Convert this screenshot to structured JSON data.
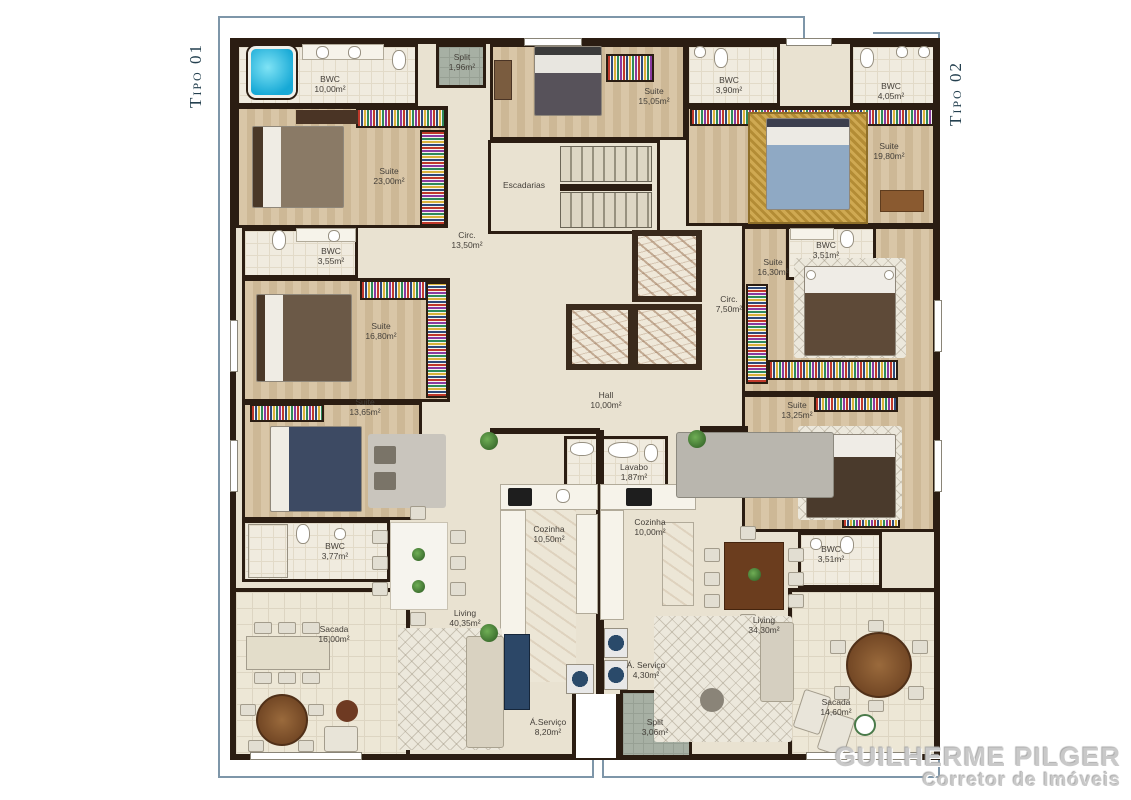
{
  "units": {
    "tipo01": {
      "label": "Tipo 01"
    },
    "tipo02": {
      "label": "Tipo 02"
    }
  },
  "rooms": {
    "bwc10": {
      "name": "BWC",
      "area": "10,00m²"
    },
    "split196": {
      "name": "Split",
      "area": "1,96m²"
    },
    "suite1505": {
      "name": "Suite",
      "area": "15,05m²"
    },
    "bwc390": {
      "name": "BWC",
      "area": "3,90m²"
    },
    "bwc405": {
      "name": "BWC",
      "area": "4,05m²"
    },
    "suite2300": {
      "name": "Suite",
      "area": "23,00m²"
    },
    "suite1980": {
      "name": "Suite",
      "area": "19,80m²"
    },
    "escadarias": {
      "name": "Escadarias",
      "area": ""
    },
    "circ1350": {
      "name": "Circ.",
      "area": "13,50m²"
    },
    "bwc355": {
      "name": "BWC",
      "area": "3,55m²"
    },
    "bwc351a": {
      "name": "BWC",
      "area": "3,51m²"
    },
    "suite1630": {
      "name": "Suite",
      "area": "16,30m²"
    },
    "suite1680": {
      "name": "Suite",
      "area": "16,80m²"
    },
    "circ750": {
      "name": "Circ.",
      "area": "7,50m²"
    },
    "hall": {
      "name": "Hall",
      "area": "10,00m²"
    },
    "suite1365": {
      "name": "Suite",
      "area": "13,65m²"
    },
    "suite1325": {
      "name": "Suite",
      "area": "13,25m²"
    },
    "lavabo": {
      "name": "Lavabo",
      "area": "1,87m²"
    },
    "bwc377": {
      "name": "BWC",
      "area": "3,77m²"
    },
    "cozinha1050": {
      "name": "Cozinha",
      "area": "10,50m²"
    },
    "cozinha1000": {
      "name": "Cozinha",
      "area": "10,00m²"
    },
    "bwc351b": {
      "name": "BWC",
      "area": "3,51m²"
    },
    "sacada16": {
      "name": "Sacada",
      "area": "16,00m²"
    },
    "living4035": {
      "name": "Living",
      "area": "40,35m²"
    },
    "living3430": {
      "name": "Living",
      "area": "34,30m²"
    },
    "aserv430": {
      "name": "Á. Serviço",
      "area": "4,30m²"
    },
    "aserv820": {
      "name": "Á.Serviço",
      "area": "8,20m²"
    },
    "split306": {
      "name": "Split",
      "area": "3,06m²"
    },
    "sacada1460": {
      "name": "Sacada",
      "area": "14,60m²"
    }
  },
  "watermark": {
    "name": "GUILHERME PILGER",
    "role": "Corretor de Imóveis"
  },
  "colors": {
    "wall": "#2b1d12",
    "floor": "#e9e2d1",
    "bracket": "#7e96a9",
    "accent_gold": "#c9a84c",
    "jacuzzi_blue": "#17a9d6"
  }
}
